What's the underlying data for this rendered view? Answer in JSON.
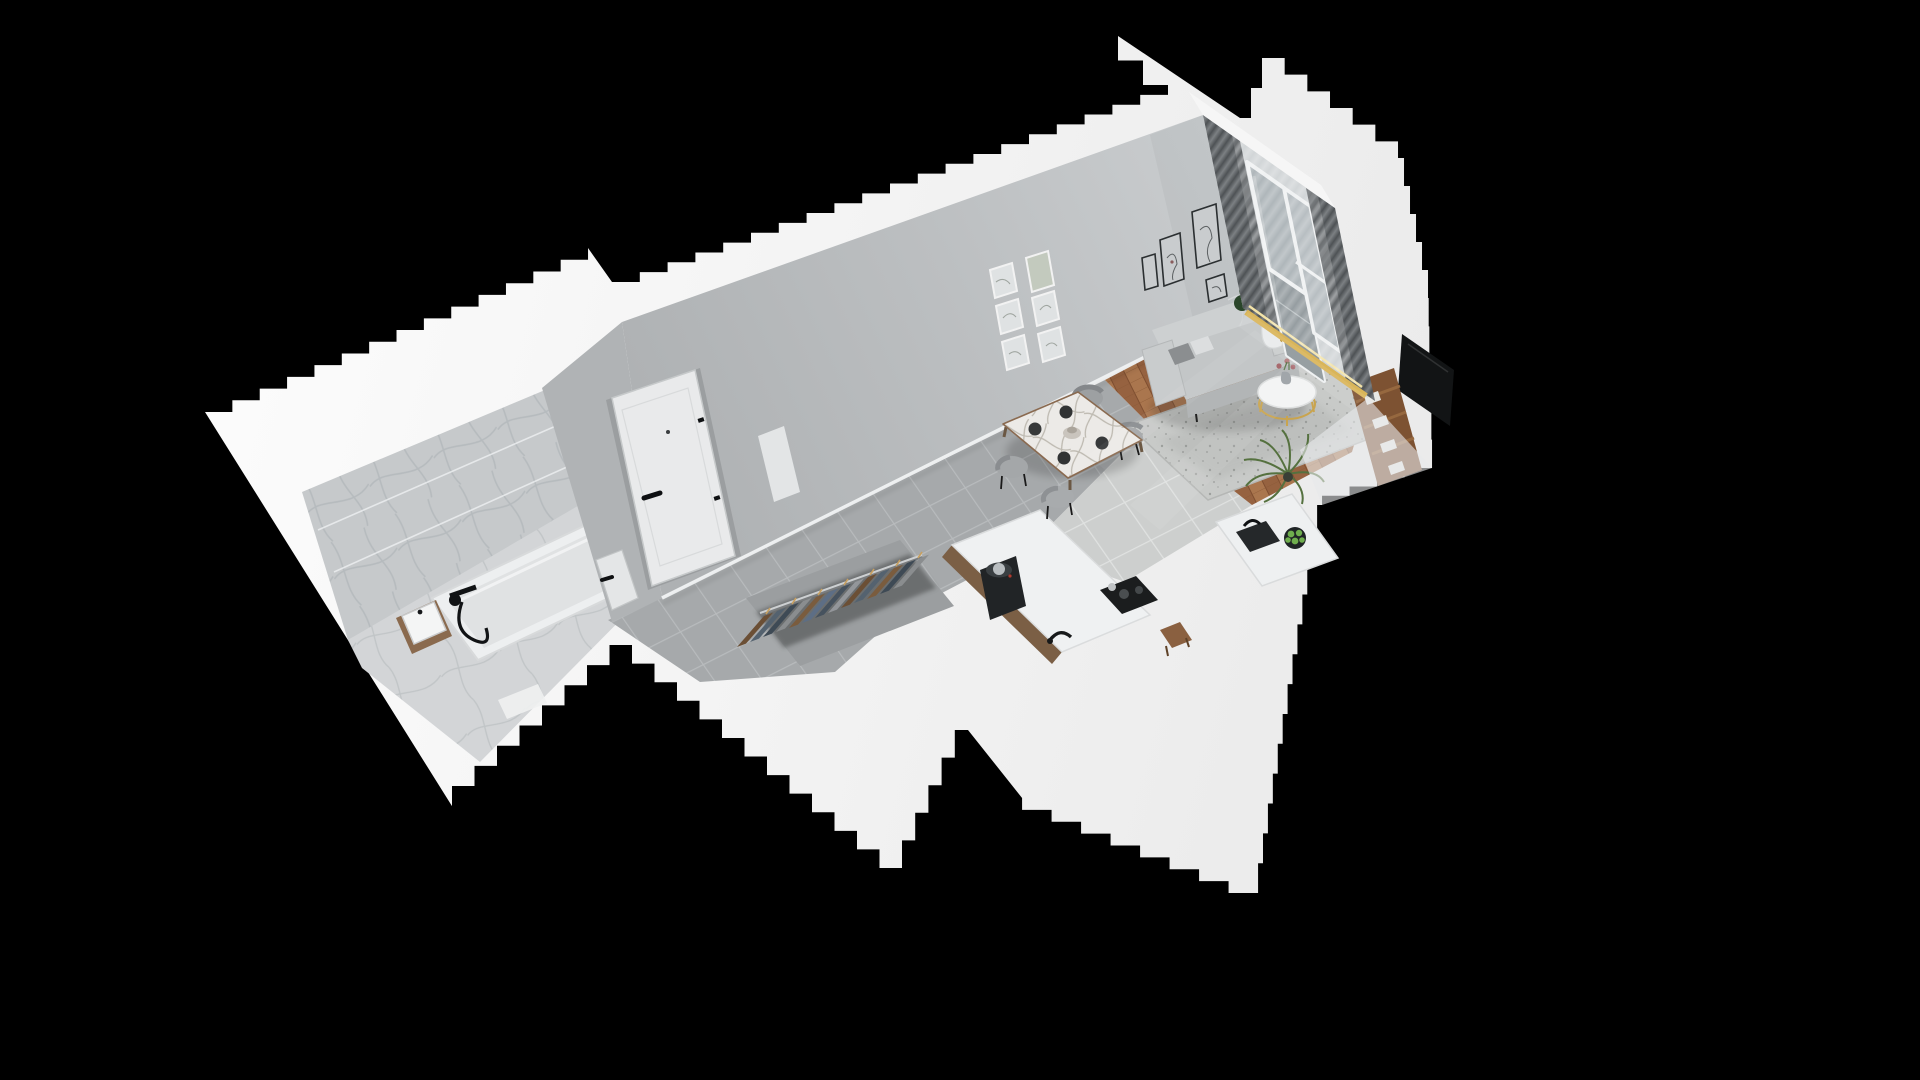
{
  "scene": {
    "title": "3D isometric cutaway render of a studio apartment",
    "view": "dollhouse floor plan, elevated oblique angle",
    "background_color": "#000000",
    "wall_cut_color": "#f5f5f5",
    "render_width": 1920,
    "render_height": 1080
  },
  "palette": {
    "background": "#000000",
    "cut_wall_white": "#f4f4f4",
    "interior_wall_gray": "#bcbfc1",
    "marble_tile": "#c9ccce",
    "hall_tile_gray": "#a6a9ab",
    "kitchen_tile_light": "#cdcfce",
    "parquet_wood": "#a9764e",
    "rug_gray": "#c8cac8",
    "sofa_gray": "#c6c9ca",
    "curtain_dark": "#5d6164",
    "sheer_curtain": "#e9ecee",
    "accent_gold": "#c9a44e",
    "appliance_black": "#1b1d1f",
    "plant_green": "#3d5c38",
    "shelf_wood_brown": "#7d5232",
    "frame_black": "#2b2f31",
    "frame_white": "#f2f2f2"
  },
  "rooms": [
    {
      "name": "bathroom",
      "floor": "marble tile",
      "items": [
        "bathtub",
        "black wall mixer with hand shower",
        "glass shower screen",
        "vanity with basin",
        "bath mat"
      ]
    },
    {
      "name": "hallway",
      "floor": "gray ceramic tile",
      "items": [
        "entry door with black handle",
        "bathroom door"
      ]
    },
    {
      "name": "wardrobe",
      "floor": "gray tile",
      "items": [
        "open closet",
        "clothes rail",
        "hanging clothes on wooden hangers"
      ]
    },
    {
      "name": "kitchen",
      "floor": "light ceramic tile",
      "items": [
        "white counter",
        "espresso machine",
        "black faucet",
        "cooktop",
        "island with sink",
        "fruit bowl with green apples",
        "wooden stool"
      ]
    },
    {
      "name": "dining area",
      "floor": "gray tile and parquet",
      "items": [
        "marble dining table",
        "four gray chairs",
        "dark plates",
        "serving bowl"
      ]
    },
    {
      "name": "living room",
      "floor": "herringbone parquet",
      "items": [
        "gray sofa with white throw",
        "cushions",
        "speckled gray rug",
        "round coffee table with gold base",
        "vase with flowers",
        "gold floor lamp with white globe",
        "monstera plant",
        "palm plant",
        "tv panel",
        "wooden shelf with books"
      ]
    },
    {
      "name": "balcony",
      "floor": "gray tile",
      "items": [
        "glazed balcony door",
        "window",
        "dark curtains",
        "sheer curtain",
        "gold threshold strip"
      ]
    }
  ],
  "wall_art": {
    "cluster_above_dining": {
      "frames": 6,
      "style": "white frames, botanical prints"
    },
    "cluster_above_sofa": {
      "frames": 5,
      "style": "thin black frames, line art"
    }
  }
}
